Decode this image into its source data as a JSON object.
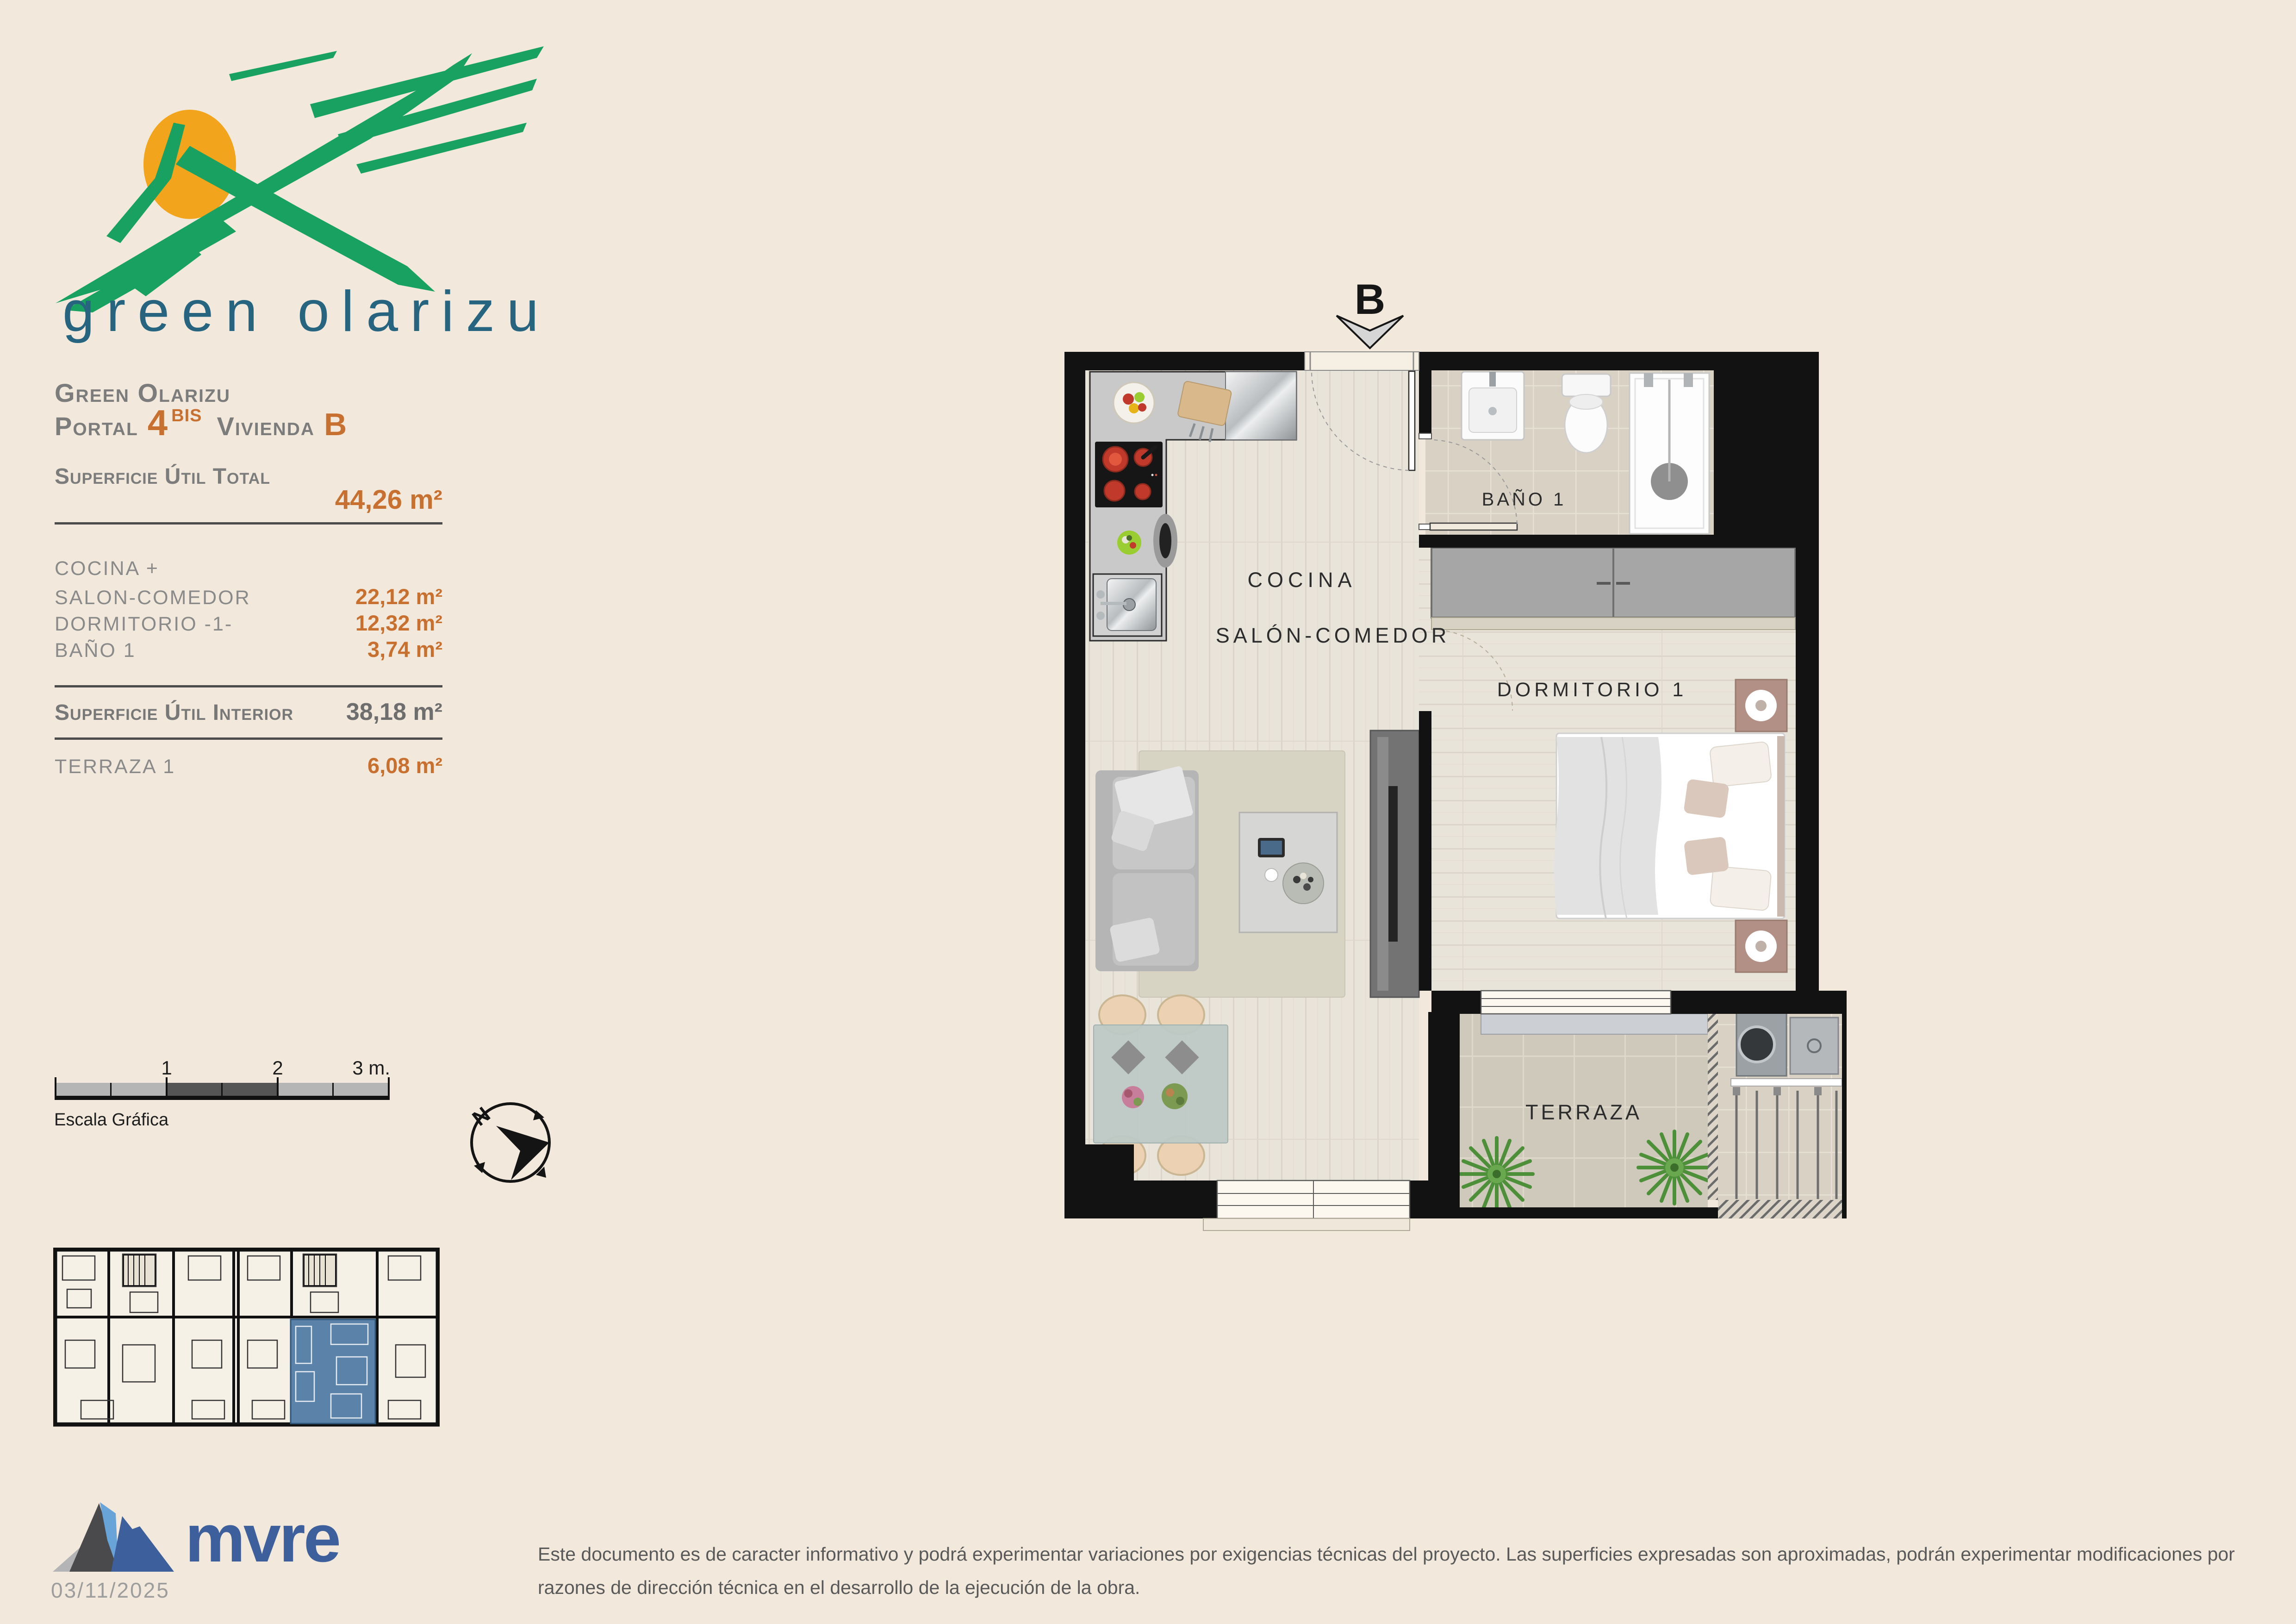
{
  "brand": {
    "name": "green olarizu",
    "green": "#18a160",
    "sun": "#f2a41c",
    "text_color": "#27647f"
  },
  "info_panel": {
    "project": "Green Olarizu",
    "portal_label": "Portal",
    "portal_number": "4",
    "portal_sup": "BIS",
    "vivienda_label": "Vivienda",
    "vivienda_letter": "B",
    "total_label": "Superficie Útil Total",
    "total_value": "44,26 m²",
    "rooms": [
      {
        "label": "COCINA +",
        "value": ""
      },
      {
        "label": "SALON-COMEDOR",
        "value": "22,12 m²"
      },
      {
        "label": "DORMITORIO -1-",
        "value": "12,32 m²"
      },
      {
        "label": "BAÑO 1",
        "value": "3,74 m²"
      }
    ],
    "interior_label": "Superficie Útil Interior",
    "interior_value": "38,18 m²",
    "terrace_label": "TERRAZA 1",
    "terrace_value": "6,08 m²"
  },
  "scale_bar": {
    "label": "Escala Gráfica",
    "tick1": "1",
    "tick2": "2",
    "tick3": "3 m."
  },
  "compass": {
    "north": "N"
  },
  "floor_plan": {
    "section_marker": "B",
    "labels": {
      "bathroom": "BAÑO 1",
      "kitchen": "COCINA",
      "living": "SALÓN-COMEDOR",
      "bedroom": "DORMITORIO 1",
      "terrace": "TERRAZA"
    }
  },
  "footer": {
    "company": "mvre",
    "date": "03/11/2025",
    "disclaimer_line1": "Este documento es de caracter informativo y podrá experimentar variaciones por exigencias técnicas del proyecto. Las superficies expresadas son aproximadas, podrán experimentar modificaciones por",
    "disclaimer_line2": "razones de dirección técnica en el desarrollo de la ejecución de la obra."
  },
  "colors": {
    "accent_orange": "#c8702f",
    "heading_gray": "#7c7c7c",
    "mvre_blue": "#3d5f9c",
    "keyplan_highlight": "#5b83aa",
    "wall_black": "#121212",
    "page_background": "#f2e9dc"
  }
}
